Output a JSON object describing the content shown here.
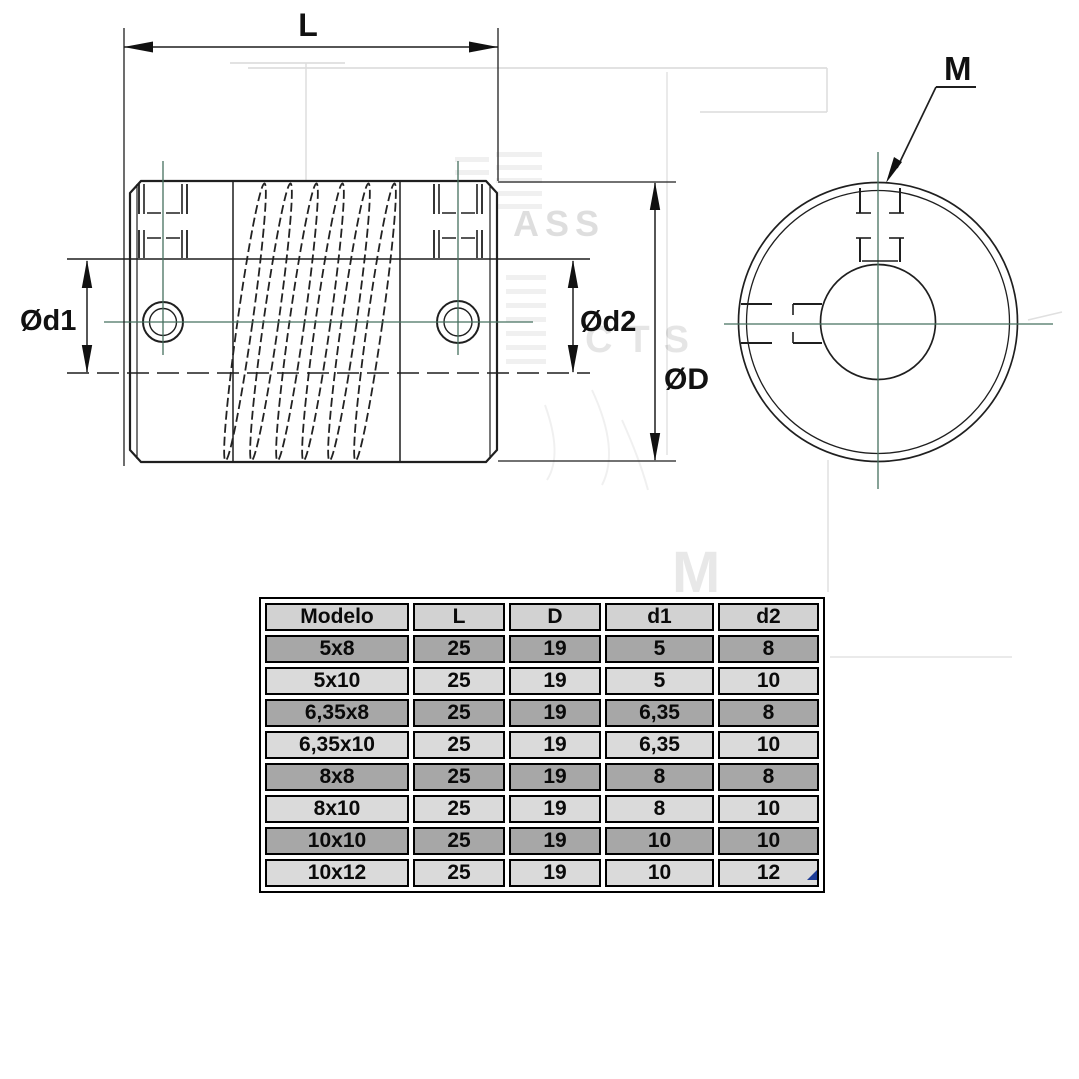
{
  "page": {
    "background": "#ffffff"
  },
  "drawing": {
    "labels": {
      "length": "L",
      "bore_left": "Ød1",
      "bore_right": "Ød2",
      "outer_diameter": "ØD",
      "thread": "M"
    },
    "watermark": {
      "frag1": "ASS",
      "frag2": "CTS",
      "frag3": "M"
    },
    "colors": {
      "line": "#1f1f1f",
      "centerline": "#46705f",
      "watermark": "#d9d9d9"
    }
  },
  "table": {
    "headers": [
      "Modelo",
      "L",
      "D",
      "d1",
      "d2"
    ],
    "rows": [
      [
        "5x8",
        "25",
        "19",
        "5",
        "8"
      ],
      [
        "5x10",
        "25",
        "19",
        "5",
        "10"
      ],
      [
        "6,35x8",
        "25",
        "19",
        "6,35",
        "8"
      ],
      [
        "6,35x10",
        "25",
        "19",
        "6,35",
        "10"
      ],
      [
        "8x8",
        "25",
        "19",
        "8",
        "8"
      ],
      [
        "8x10",
        "25",
        "19",
        "8",
        "10"
      ],
      [
        "10x10",
        "25",
        "19",
        "10",
        "10"
      ],
      [
        "10x12",
        "25",
        "19",
        "10",
        "12"
      ]
    ],
    "colors": {
      "header_bg": "#d2d2d2",
      "row_dark_bg": "#a7a7a7",
      "row_light_bg": "#dadada",
      "border": "#000000",
      "corner_marker": "#1d3c96"
    }
  }
}
